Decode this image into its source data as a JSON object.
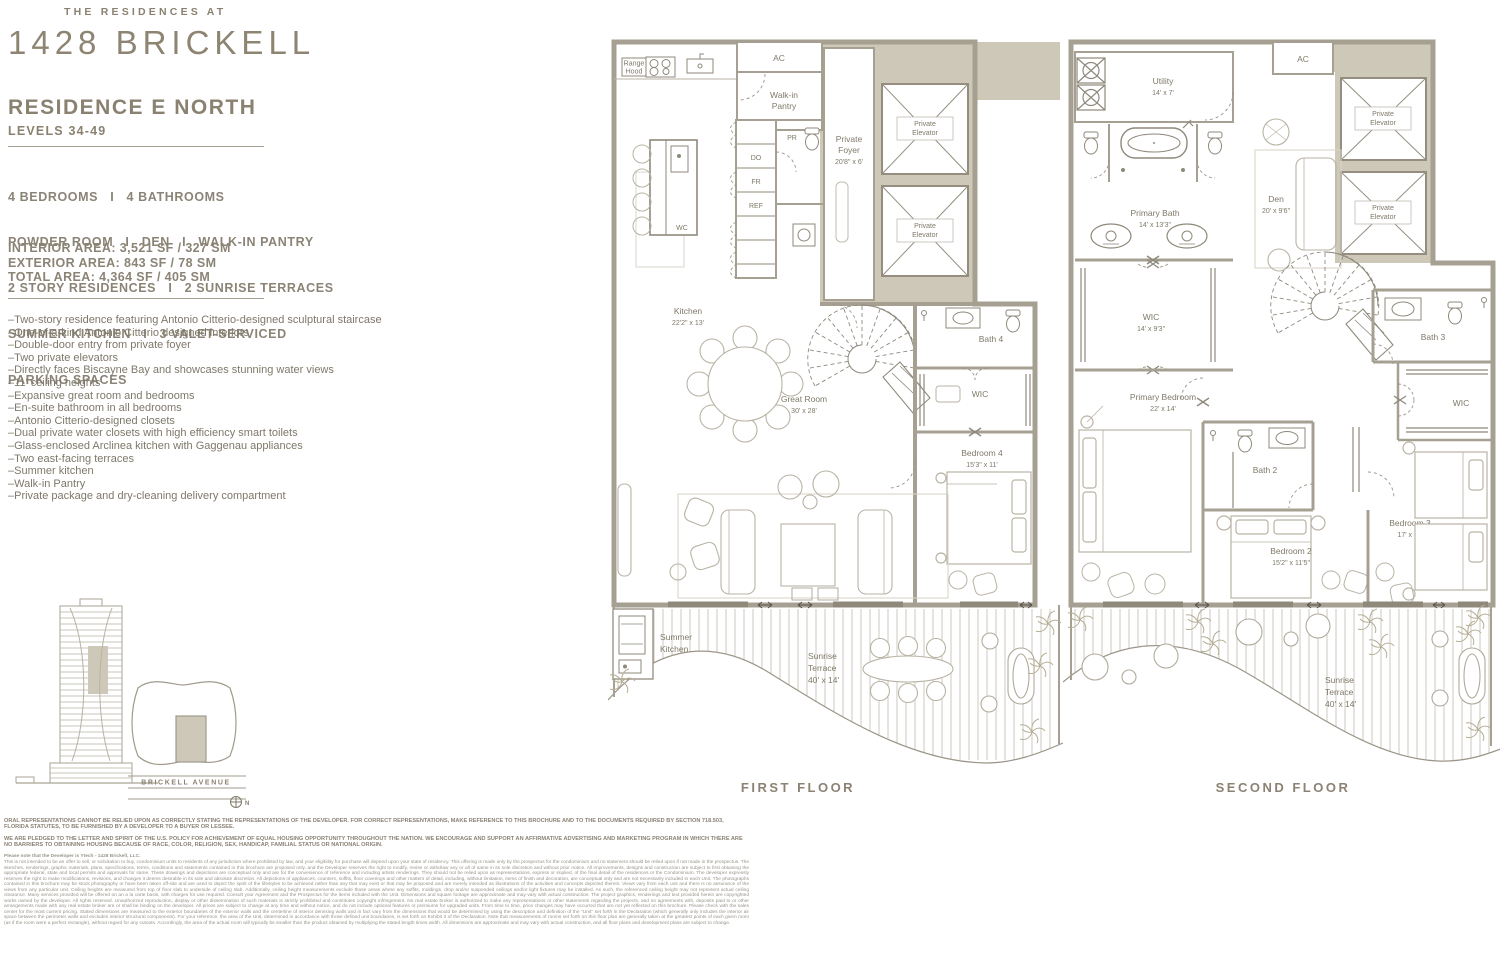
{
  "brand": {
    "pre": "THE RESIDENCES AT",
    "name": "1428 BRICKELL"
  },
  "residence": {
    "title": "RESIDENCE E NORTH",
    "levels": "LEVELS 34-49"
  },
  "specs": [
    "4 BEDROOMS   I   4 BATHROOMS",
    "POWDER ROOM   I   DEN   I   WALK-IN PANTRY",
    "2 STORY RESIDENCES   I   2 SUNRISE TERRACES",
    "SUMMER KITCHEN   I   3 VALET-SERVICED",
    "PARKING SPACES"
  ],
  "areas": [
    "INTERIOR AREA: 3,521 SF / 327 SM",
    "EXTERIOR AREA: 843 SF / 78 SM",
    "TOTAL AREA: 4,364 SF / 405 SM"
  ],
  "features": [
    "–Two-story residence featuring Antonio Citterio-designed sculptural staircase",
    "–One-of-a-kind Antonio Citterio designed interiors",
    "–Double-door entry from private foyer",
    "–Two private elevators",
    "–Directly faces Biscayne Bay and showcases stunning water views",
    "–11' ceiling heights",
    "–Expansive great room and bedrooms",
    "–En-suite bathroom in all bedrooms",
    "–Antonio Citterio-designed closets",
    "–Dual private water closets with high efficiency smart toilets",
    "–Glass-enclosed Arclinea kitchen with Gaggenau appliances",
    "–Two east-facing terraces",
    "–Summer kitchen",
    "–Walk-in Pantry",
    "–Private package and dry-cleaning delivery compartment"
  ],
  "site": {
    "street": "BRICKELL AVENUE",
    "north": "N"
  },
  "floor1": {
    "caption": "FIRST FLOOR",
    "labels": {
      "rangehood1": "Range",
      "rangehood2": "Hood",
      "ac": "AC",
      "pantry1": "Walk-in",
      "pantry2": "Pantry",
      "foyer1": "Private",
      "foyer2": "Foyer",
      "foyer_dims": "20'8\" x 6'",
      "elev1": "Private",
      "elev2": "Elevator",
      "pr": "PR",
      "do": "DO",
      "fr": "FR",
      "ref": "REF",
      "wc": "WC",
      "kitchen": "Kitchen",
      "kitchen_dims": "22'2\" x 13'",
      "great": "Great Room",
      "great_dims": "30' x 28'",
      "bath4": "Bath 4",
      "wic": "WIC",
      "bed4": "Bedroom 4",
      "bed4_dims": "15'3\" x 11'",
      "summer1": "Summer",
      "summer2": "Kitchen",
      "ter1": "Sunrise",
      "ter2": "Terrace",
      "ter_dims": "40' x 14'"
    }
  },
  "floor2": {
    "caption": "SECOND FLOOR",
    "labels": {
      "utility": "Utility",
      "utility_dims": "14' x 7'",
      "ac": "AC",
      "elev1": "Private",
      "elev2": "Elevator",
      "pbath": "Primary Bath",
      "pbath_dims": "14' x 13'3\"",
      "den": "Den",
      "den_dims": "20' x 9'6\"",
      "wic": "WIC",
      "wic_dims": "14' x 9'3\"",
      "pbed": "Primary Bedroom",
      "pbed_dims": "22' x 14'",
      "bath2": "Bath 2",
      "bed2": "Bedroom 2",
      "bed2_dims": "15'2\" x 11'5\"",
      "bath3": "Bath 3",
      "wic2": "WIC",
      "bed3": "Bedroom 3",
      "bed3_dims": "17' x 11'",
      "ter1": "Sunrise",
      "ter2": "Terrace",
      "ter_dims": "40' x 14'"
    }
  },
  "legal": {
    "p1": "ORAL REPRESENTATIONS CANNOT BE RELIED UPON AS CORRECTLY STATING THE REPRESENTATIONS OF THE DEVELOPER. FOR CORRECT REPRESENTATIONS, MAKE REFERENCE TO THIS BROCHURE AND TO THE DOCUMENTS REQUIRED BY SECTION 718.503, FLORIDA STATUTES, TO BE FURNISHED BY A DEVELOPER TO A BUYER OR LESSEE.",
    "p2": "WE ARE PLEDGED TO THE LETTER AND SPIRIT OF THE U.S. POLICY FOR ACHIEVEMENT OF EQUAL HOUSING OPPORTUNITY THROUGHOUT THE NATION. WE ENCOURAGE AND SUPPORT AN AFFIRMATIVE ADVERTISING AND MARKETING PROGRAM IN WHICH THERE ARE NO BARRIERS TO OBTAINING HOUSING BECAUSE OF RACE, COLOR, RELIGION, SEX, HANDICAP, FAMILIAL STATUS OR NATIONAL ORIGIN.",
    "p3": "Please note that the Developer is Ytech - 1428 Brickell, LLC.",
    "p4": "This is not intended to be an offer to sell, or solicitation to buy, condominium units to residents of any jurisdiction where prohibited by law, and your eligibility for purchase will depend upon your state of residency. This offering is made only by the prospectus for the condominium and no statement should be relied upon if not made in the prospectus. The sketches, renderings, graphic materials, plans, specifications, terms, conditions and statements contained in this brochure are proposed only, and the Developer reserves the right to modify, revise or withdraw any or all of same in its sole discretion and without prior notice. All improvements, designs and construction are subject to first obtaining the appropriate federal, state and local permits and approvals for same. These drawings and depictions are conceptual only and are for the convenience of reference and including artists renderings. They should not be relied upon as representations, express or implied, of the final detail of the residences or the Condominium. The developer expressly reserves the right to make modifications, revisions, and changes it deems desirable in its sole and absolute discretion. All depictions of appliances, counters, soffits, floor coverings and other matters of detail, including, without limitation, items of finish and decoration, are conceptual only and are not necessarily included in each Unit. The photographs contained in this brochure may be stock photography or have been taken off-site and are used to depict the spirit of the lifestyles to be achieved rather than any that may exist or that may be proposed and are merely intended as illustrations of the activities and concepts depicted therein. Views vary from each unit and there is no assurance of the views from any particular unit. Ceiling heights are measured from top of floor slab to underside of ceiling slab. Additionally, ceiling height measurements exclude those areas where any soffits, moldings, drop and/or suspended ceilings and/or light fixtures may be installed. As such, the referenced ceiling height may not represent actual ceiling clearance. Many services provided will be offered on an a la carte basis, with charges for use required. Consult your Agreement and the Prospectus for the items included with the Unit. Dimensions and square footage are approximate and may vary with actual construction. The project graphics, renderings and text provided herein are copyrighted works owned by the developer. All rights reserved. Unauthorized reproduction, display or other dissemination of such materials is strictly prohibited and constitutes copyright infringement. No real estate broker is authorized to make any representations or other statements regarding the projects, and no agreements with, deposits paid to or other arrangements made with any real estate broker are or shall be binding on the developer. All prices are subject to change at any time and without notice, and do not include optional features or premiums for upgraded units. From time to time, price changes may have occurred that are not yet reflected on this brochure. Please check with the sales center for the most current pricing. Stated dimensions are measured to the exterior boundaries of the exterior walls and the centerline of interior demising walls and in fact vary from the dimensions that would be determined by using the description and definition of the \"Unit\" set forth in the Declaration (which generally only includes the interior air space between the perimeter walls and excludes interior structural components). For your reference, the area of the Unit, determined in accordance with those defined unit boundaries, is set forth on Exhibit 3 of the Declaration. Note that measurements of rooms set forth on this floor plan are generally taken at the greatest points of each given room (as if the room were a perfect rectangle), without regard for any cutouts. Accordingly, the area of the actual room will typically be smaller than the product obtained by multiplying the stated length times width. All dimensions are approximate and may vary with actual construction, and all floor plans and development plans are subject to change."
  },
  "colors": {
    "accent": "#8b8170",
    "wall": "#a6a092",
    "core_fill": "#cdc8b8",
    "text": "#7e7869"
  }
}
